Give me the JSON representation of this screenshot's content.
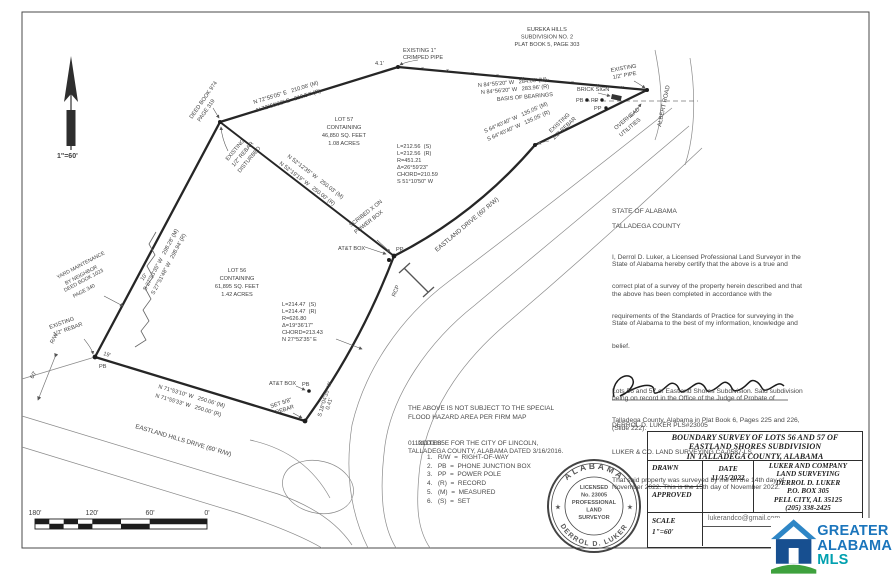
{
  "north": {
    "scale_label": "1\"=60'"
  },
  "adjoiner": {
    "eureka": [
      "EUREKA HILLS",
      "SUBDIVISION NO. 2",
      "PLAT BOOK 5, PAGE 303"
    ],
    "deed974": [
      "DEED BOOK 974",
      "PAGE 319"
    ],
    "yard": [
      "YARD MAINTENANCE",
      "BY NEIGHBOR",
      "DEED BOOK 1023",
      "PAGE 340"
    ]
  },
  "lots": {
    "lot57": [
      "LOT 57",
      "CONTAINING",
      "46,850 SQ. FEET",
      "1.08 ACRES"
    ],
    "lot56": [
      "LOT 56",
      "CONTAINING",
      "61,895 SQ. FEET",
      "1.42 ACRES"
    ]
  },
  "bearings": {
    "north1": "N 84°55'20\" W   284.06' (M)",
    "north2": "N 84°56'20\" W   283.96' (R)",
    "basis": "BASIS OF BEARINGS",
    "topleft1": "N 72°55'05\" E   210.06' (M)",
    "topleft2": "N 72°50'32\" E   210.54' (R)",
    "ne1": "S 64°40'40\" W   135.05' (M)",
    "ne2": "S 64°40'40\" W   135.05' (R)",
    "divide1": "N 52°12'35\" W   250.03' (M)",
    "divide2": "N 52°19'19\" W   250.00' (R)",
    "west1": "S 27°53'35\" W   298.28' (M)",
    "west2": "S 27°51'48\" W   298.94' (R)",
    "south1": "N 71°53'10\" W   250.06' (M)",
    "south2": "N 71°55'33\" W   250.00' (R)",
    "tie1": "S 18°04'35\" W",
    "tie2": "0.41'"
  },
  "curves": {
    "c1": [
      "L=212.56  (S)",
      "L=212.56  (R)",
      "R=451.21",
      "Δ=26°59'23\"",
      "CHORD=210.59",
      "S 51°10'50\" W"
    ],
    "c2": [
      "L=214.47  (S)",
      "L=214.47  (R)",
      "R=626.80",
      "Δ=19°36'17\"",
      "CHORD=213.43",
      "N 27°52'35\" E"
    ]
  },
  "monuments": {
    "crimped1": "EXISTING 1\"",
    "crimped2": "CRIMPED PIPE",
    "crimped_offset": "4.1'",
    "half_pipe1": "EXISTING",
    "half_pipe2": "1/2\" PIPE",
    "rebar_ne1": "EXISTING",
    "rebar_ne2": "1/2\" REBAR",
    "rebar_dist1": "EXISTING",
    "rebar_dist2": "1/2\" REBAR",
    "rebar_dist3": "DISTURBED",
    "rebar_sw1": "EXISTING",
    "rebar_sw2": "1/2\" REBAR",
    "set_rebar1": "SET 5/8\"",
    "set_rebar2": "REBAR",
    "scribed1": "SCRIBED X ON",
    "scribed2": "POWER BOX",
    "att_mid": "AT&T BOX",
    "att_se": "AT&T BOX",
    "brick_sign": "BRICK SIGN",
    "pb": "PB",
    "pp": "PP",
    "rcp": "RCP"
  },
  "roads": {
    "eastland_drive": "EASTLAND DRIVE (60' R/W)",
    "eastland_hills": "EASTLAND HILLS DRIVE (60' R/W)",
    "albert": "ALBERT ROAD",
    "overhead1": "OVERHEAD",
    "overhead2": "UTILITIES",
    "rw": "R/W",
    "d60": "60'",
    "d19": "19'",
    "d10": "10'"
  },
  "flood": [
    "THE ABOVE IS NOT SUBJECT TO THE SPECIAL",
    "FLOOD HAZARD AREA PER FIRM MAP",
    "01121C0085E FOR THE CITY OF LINCOLN,",
    "TALLADEGA COUNTY, ALABAMA DATED 3/16/2016."
  ],
  "notes": {
    "title": "NOTES:",
    "items": [
      "1.   R/W  =  RIGHT-OF-WAY",
      "2.   PB  =  PHONE JUNCTION BOX",
      "3.   PP  =  POWER POLE",
      "4.   (R)  =  RECORD",
      "5.   (M)  =  MEASURED",
      "6.   (S)  =  SET"
    ]
  },
  "certification": {
    "state": "STATE OF ALABAMA",
    "county": "TALLADEGA COUNTY",
    "para1": [
      "I, Derrol D. Luker, a Licensed Professional Land Surveyor in the",
      "State of Alabama hereby certify that the above is a true and",
      "correct plat of a survey of the property herein described and that",
      "the above has been completed in accordance with the",
      "requirements of the Standards of Practice for surveying in the",
      "State of Alabama to the best of my information, knowledge and",
      "belief."
    ],
    "para2": [
      "Lots 56 and 57 of Eastland Shores Subdivision. Said subdivision",
      "being on record in the Office of the Judge of Probate of",
      "Talladega County, Alabama in Plat Book 6, Pages 225 and 226,",
      "(Slide 222)."
    ],
    "para3": [
      "That said property was surveyed by me on the 14th day of",
      "November 2022. This is the 15th day of November 2022."
    ],
    "surveyor_line1": "DERROL D. LUKER PLS#23005",
    "surveyor_line2": "LUKER & CO. LAND SURVEYING CA-0587-LS"
  },
  "seal": {
    "top": "ALABAMA",
    "bottom": "DERROL D. LUKER",
    "l1": "LICENSED",
    "l2": "No. 23005",
    "l3": "PROFESSIONAL",
    "l4": "LAND",
    "l5": "SURVEYOR",
    "star": "★"
  },
  "title_block": {
    "title1": "BOUNDARY SURVEY OF LOTS 56 AND 57 OF",
    "title2": "EASTLAND SHORES SUBDIVISION",
    "title3": "IN TALLADEGA COUNTY, ALABAMA",
    "drawn": "DRAWN",
    "date_label": "DATE",
    "date": "11/15/2022",
    "approved": "APPROVED",
    "company": [
      "LUKER AND COMPANY",
      "LAND SURVEYING",
      "DERROL D. LUKER",
      "P.O. BOX 305",
      "PELL CITY, AL 35125",
      "(205) 338-2425"
    ],
    "scale_label": "SCALE",
    "scale": "1\"=60'",
    "email": "lukerandco@gmail.com"
  },
  "scale_bar": {
    "l180": "180'",
    "l120": "120'",
    "l60": "60'",
    "l0": "0'"
  },
  "mls": {
    "l1": "GREATER",
    "l2": "ALABAMA",
    "l3": "MLS",
    "blue": "#1b75bc",
    "teal": "#00a0af",
    "roof": "#2e86c6",
    "body": "#174f90",
    "green": "#3ea13d"
  }
}
